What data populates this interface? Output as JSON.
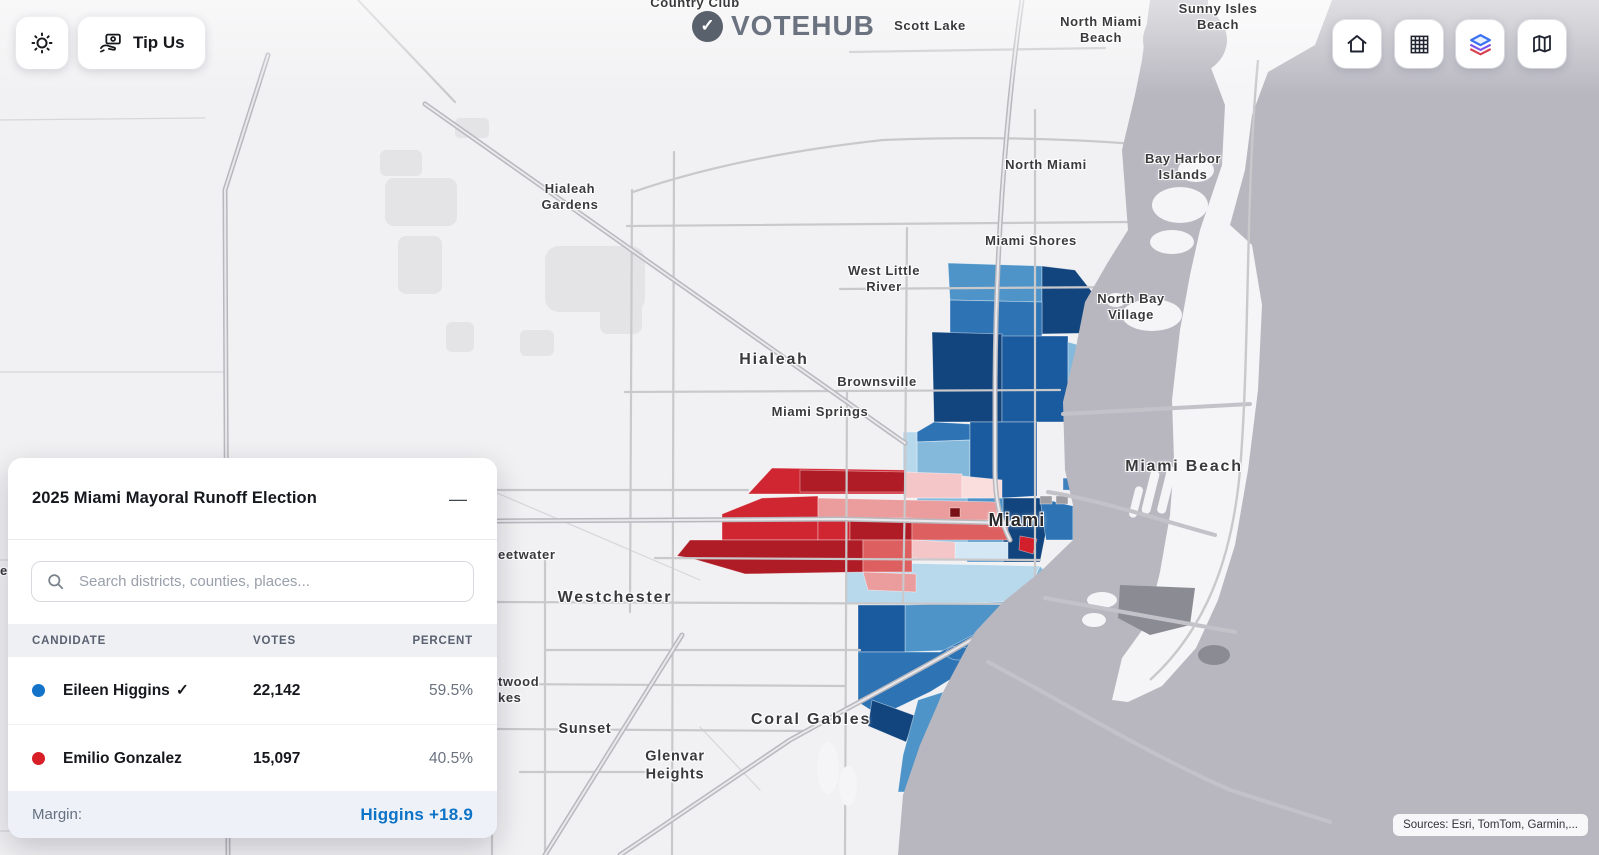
{
  "header": {
    "logo": {
      "text": "VOTEHUB",
      "icon": "check-circle-icon",
      "check": "✓"
    },
    "theme_toggle": {
      "icon": "sun-icon"
    },
    "tip_us": {
      "label": "Tip Us",
      "icon": "hand-money-icon"
    },
    "nav": [
      {
        "icon": "home-icon"
      },
      {
        "icon": "grid-icon"
      },
      {
        "icon": "layers-icon"
      },
      {
        "icon": "map-icon"
      }
    ]
  },
  "panel": {
    "title": "2025 Miami Mayoral Runoff Election",
    "collapse_icon": "—",
    "search": {
      "placeholder": "Search districts, counties, places..."
    },
    "table": {
      "columns": [
        "CANDIDATE",
        "VOTES",
        "PERCENT"
      ],
      "rows": [
        {
          "name": "Eileen Higgins",
          "winner_check": "✓",
          "votes": "22,142",
          "percent": "59.5%",
          "party_color": "#1273c8"
        },
        {
          "name": "Emilio Gonzalez",
          "winner_check": "",
          "votes": "15,097",
          "percent": "40.5%",
          "party_color": "#d81f27"
        }
      ]
    },
    "footer": {
      "label": "Margin:",
      "value": "Higgins +18.9",
      "value_color": "#0d73c7"
    }
  },
  "map": {
    "attribution": "Sources: Esri, TomTom, Garmin,...",
    "colors": {
      "dem_dark": "#12457e",
      "dem_mid": "#2e74b5",
      "dem_light": "#b8d8ec",
      "rep_deep": "#b01c26",
      "rep_strong": "#cf2631",
      "rep_pale": "#f4c6c7",
      "water": "#b8b7c0",
      "land": "#f1f0f2"
    },
    "labels": [
      {
        "text": "Country Club"
      },
      {
        "text": "Scott Lake"
      },
      {
        "text": "North Miami\nBeach"
      },
      {
        "text": "Sunny Isles\nBeach"
      },
      {
        "text": "North Miami"
      },
      {
        "text": "Bay Harbor\nIslands"
      },
      {
        "text": "Hialeah\nGardens"
      },
      {
        "text": "Miami Shores"
      },
      {
        "text": "West Little\nRiver"
      },
      {
        "text": "North Bay\nVillage"
      },
      {
        "text": "Hialeah"
      },
      {
        "text": "Brownsville"
      },
      {
        "text": "Miami Springs"
      },
      {
        "text": "Miami Beach"
      },
      {
        "text": "Miami"
      },
      {
        "text": "eetwater"
      },
      {
        "text": "Westchester"
      },
      {
        "text": "twood\nkes"
      },
      {
        "text": "Sunset"
      },
      {
        "text": "Coral Gables"
      },
      {
        "text": "Glenvar\nHeights"
      },
      {
        "text": "The"
      },
      {
        "text": "er"
      }
    ]
  }
}
